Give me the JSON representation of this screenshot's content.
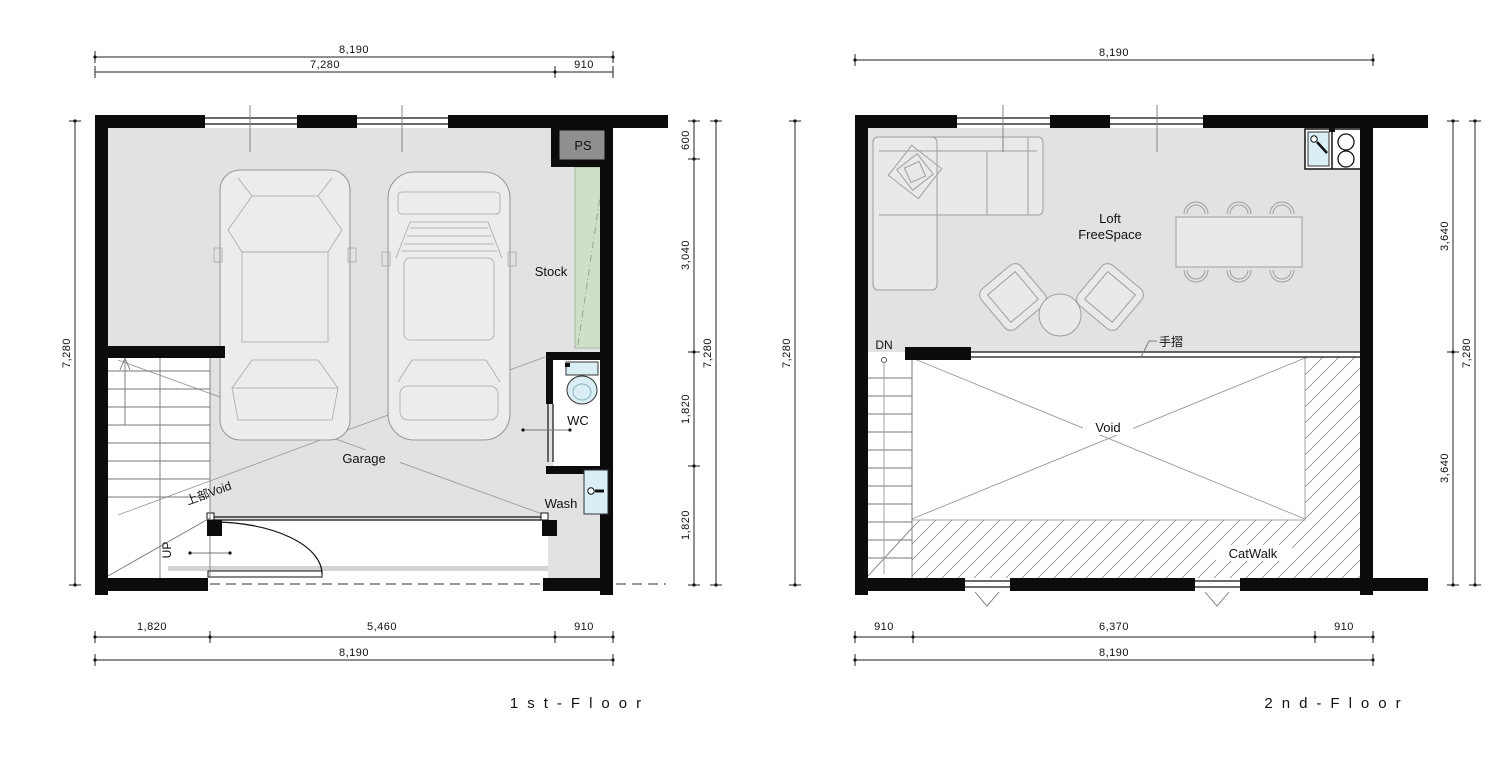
{
  "first_floor": {
    "title": "1st-Floor",
    "dims": {
      "top_total": "8,190",
      "top_segments": [
        "7,280",
        "910"
      ],
      "left_total": "7,280",
      "right_segments": [
        "600",
        "3,040",
        "1,820",
        "1,820"
      ],
      "right_total": "7,280",
      "bottom_segments": [
        "1,820",
        "5,460",
        "910"
      ],
      "bottom_total": "8,190"
    },
    "labels": {
      "ps": "PS",
      "stock": "Stock",
      "wc": "WC",
      "wash": "Wash",
      "garage": "Garage",
      "upper_void": "上部Void",
      "up": "UP"
    }
  },
  "second_floor": {
    "title": "2nd-Floor",
    "dims": {
      "top_total": "8,190",
      "left_total": "7,280",
      "right_segments": [
        "3,640",
        "3,640"
      ],
      "right_total": "7,280",
      "bottom_segments": [
        "910",
        "6,370",
        "910"
      ],
      "bottom_total": "8,190"
    },
    "labels": {
      "loft_line1": "Loft",
      "loft_line2": "FreeSpace",
      "void": "Void",
      "catwalk": "CatWalk",
      "dn": "DN",
      "handrail": "手摺"
    }
  },
  "colors": {
    "floor": "#e2e2e2",
    "wall": "#0c0c0c",
    "ps_fill": "#8f8f8f",
    "stock_fill": "#cfe0c8",
    "fixture_fill": "#daeef5",
    "hatch": "#8f8f8f",
    "furniture": "#9f9f9f",
    "dim": "#222222"
  }
}
